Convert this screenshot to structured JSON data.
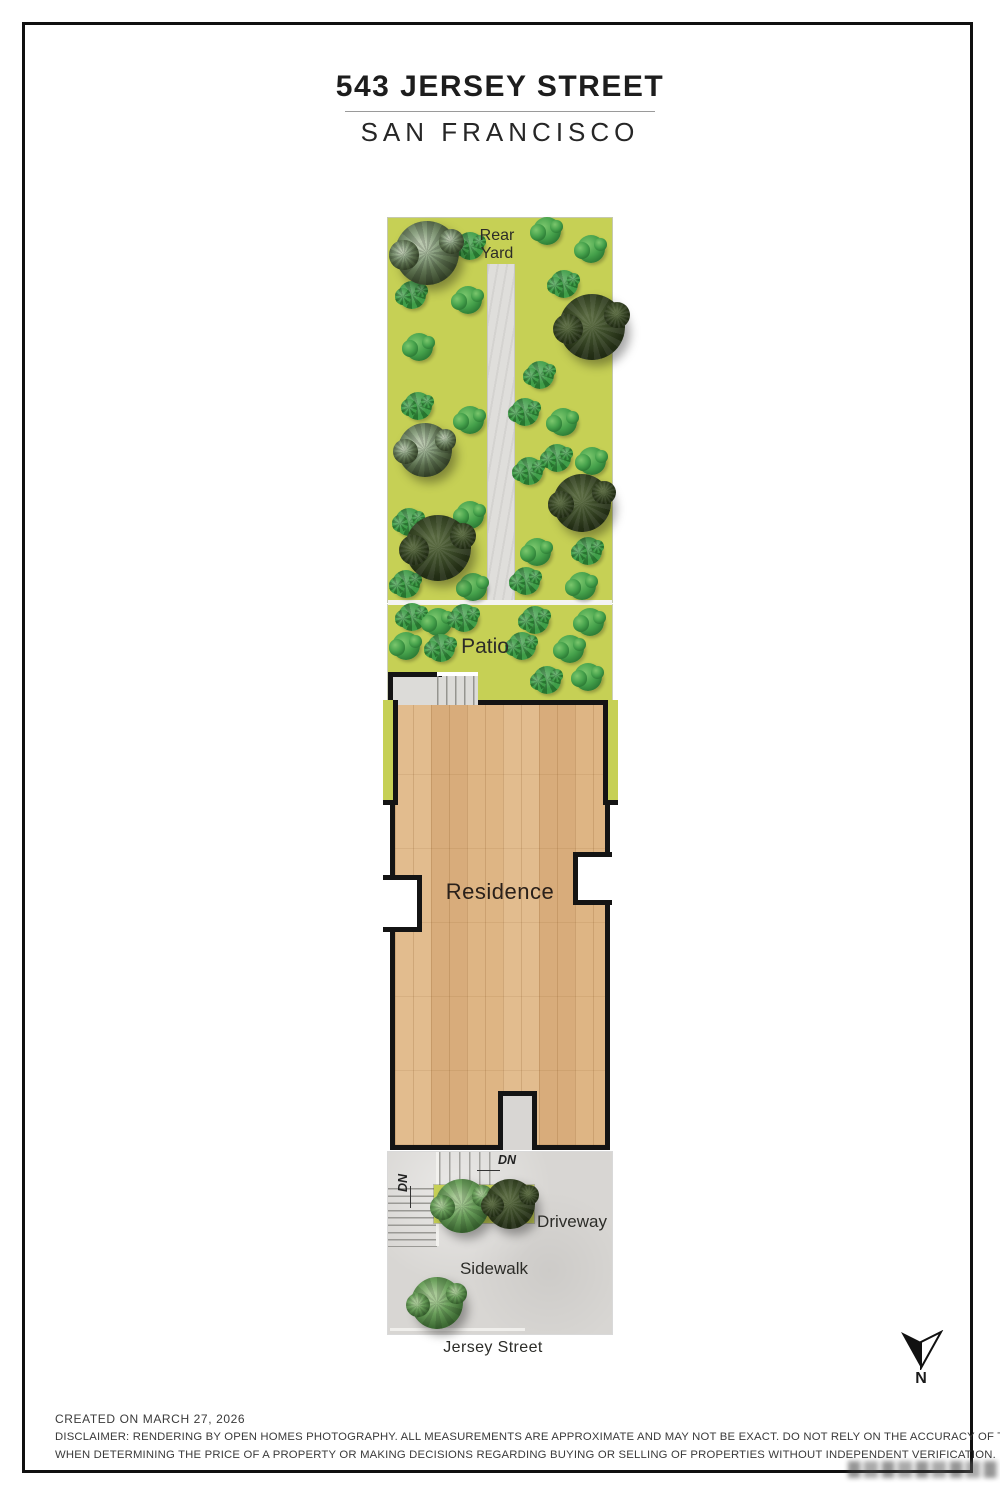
{
  "header": {
    "title": "543 JERSEY STREET",
    "subtitle": "SAN FRANCISCO"
  },
  "plan": {
    "areas": {
      "rear_yard": "Rear Yard",
      "patio": "Patio",
      "residence": "Residence",
      "driveway": "Driveway",
      "sidewalk": "Sidewalk"
    },
    "street_label": "Jersey Street",
    "stairs": {
      "dn_left": "DN",
      "dn_center": "DN"
    },
    "compass_label": "N",
    "colors": {
      "grass": "#c6d055",
      "wood": "#ddb488",
      "concrete": "#d8d6d3",
      "path": "#dfdedb",
      "outline": "#141414"
    }
  },
  "footer": {
    "created": "CREATED ON MARCH 27, 2026",
    "disclaimer_line1": "DISCLAIMER: RENDERING BY OPEN HOMES PHOTOGRAPHY. ALL MEASUREMENTS ARE APPROXIMATE AND MAY NOT BE EXACT. DO NOT RELY ON THE ACCURACY OF THIS FLOOR PLAN",
    "disclaimer_line2": "WHEN DETERMINING THE PRICE OF A PROPERTY OR MAKING DECISIONS REGARDING BUYING OR SELLING OF PROPERTIES WITHOUT INDEPENDENT VERIFICATION."
  }
}
